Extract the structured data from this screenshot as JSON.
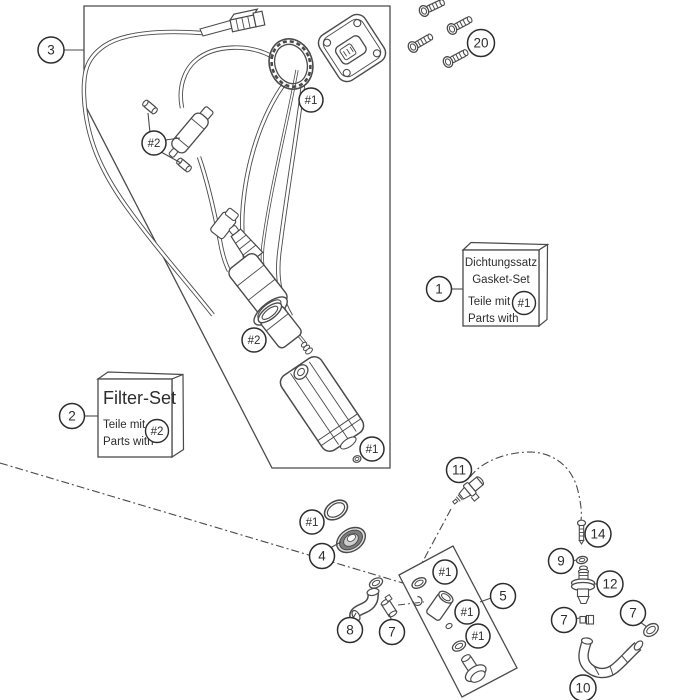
{
  "app": {
    "type": "exploded-parts-diagram",
    "subject": "fuel pump assembly",
    "background_color": "#ffffff",
    "line_color": "#4a4a4a",
    "text_color": "#2d2d2d"
  },
  "callouts": {
    "c1": "1",
    "c2": "2",
    "c3": "3",
    "c4": "4",
    "c5": "5",
    "c7": "7",
    "c8": "8",
    "c9": "9",
    "c10": "10",
    "c11": "11",
    "c12": "12",
    "c14": "14",
    "c20": "20",
    "h1": "#1",
    "h2": "#2"
  },
  "boxes": {
    "gasket_set": {
      "line1": "Dichtungssatz",
      "line2": "Gasket-Set",
      "line3": "Teile mit",
      "line4": "Parts with",
      "badge": "#1"
    },
    "filter_set": {
      "title": "Filter-Set",
      "line1": "Teile mit",
      "line2": "Parts with",
      "badge": "#2"
    }
  }
}
